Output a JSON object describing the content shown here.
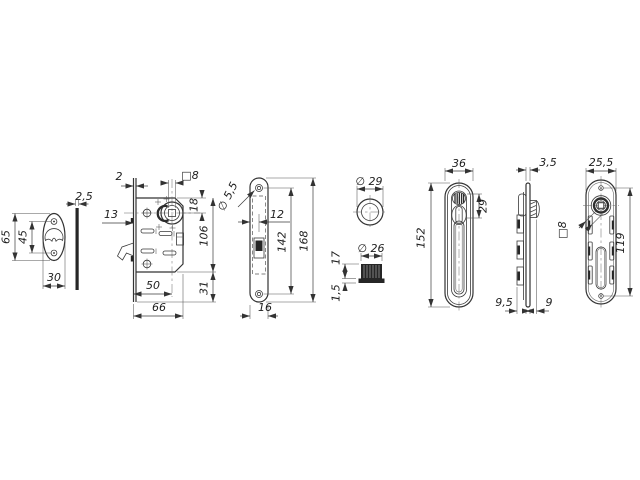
{
  "title": "Mortise lock and flush handle dimensioned drawing",
  "dims": {
    "esc_height": "65",
    "esc_holes": "45",
    "esc_width": "30",
    "esc_thick": "2,5",
    "body_plate": "2",
    "body_latch": "13",
    "body_square": "□8",
    "body_spindle_top": "18",
    "body_height": "106",
    "body_backset": "50",
    "body_width": "66",
    "body_overhang": "31",
    "face_hole": "∅ 5,5",
    "face_offset": "12",
    "face_holes": "142",
    "face_length": "168",
    "face_width": "16",
    "rose_dia": "∅ 29",
    "bush_dia": "∅ 26",
    "bush_height": "17",
    "bush_lip": "1,5",
    "front_width": "36",
    "front_turn": "29",
    "front_length": "152",
    "side_thick": "3,5",
    "side_clip": "9,5",
    "side_knob": "9",
    "back_width": "25,5",
    "back_holes": "119",
    "back_square": "□8"
  }
}
